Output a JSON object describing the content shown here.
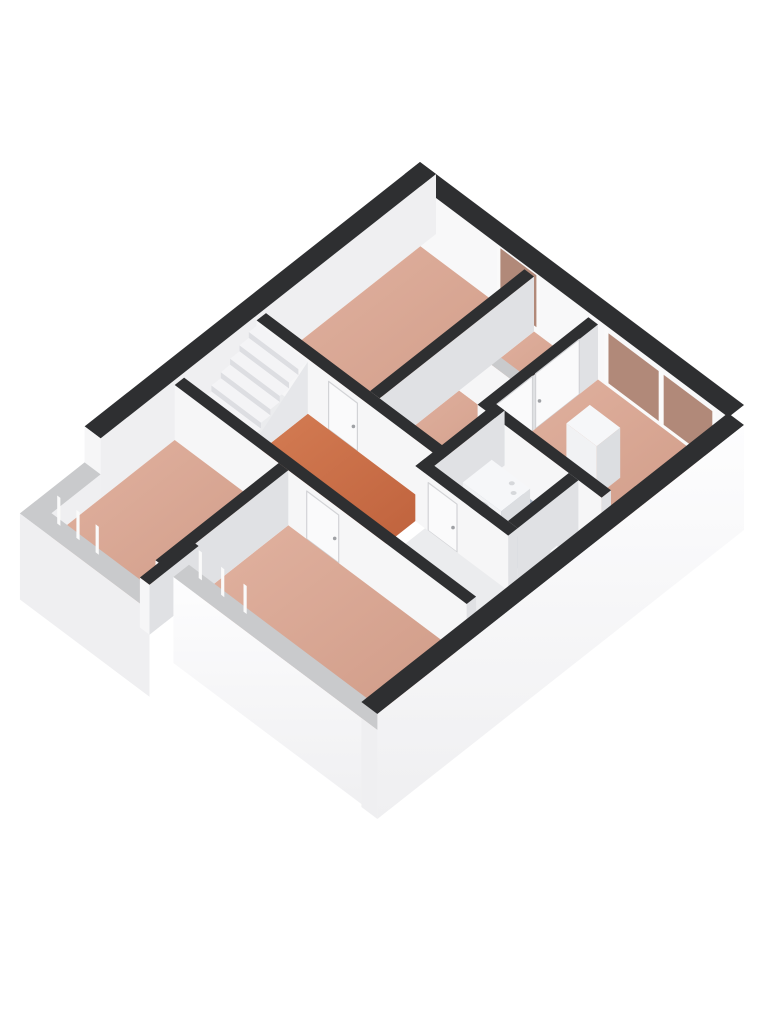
{
  "scene": {
    "type": "floor-plan-3d-isometric",
    "background": "#ffffff",
    "floor_level": "first-floor"
  },
  "colors": {
    "background": "#ffffff",
    "cap_dark": "#2e2f31",
    "cap_light": "#c9cacc",
    "face_bright": "#f6f6f7",
    "face_shaded": "#e0e1e4",
    "face_ne_inner": "#f8f8f9",
    "face_nw_inner": "#efeff1",
    "floor_salmon": "#d5a28f",
    "floor_salmon_light": "#e1b2a0",
    "floor_salmon_dark": "#cf9a86",
    "floor_orange": "#c96f4a",
    "floor_orange_light": "#d57e55",
    "floor_orange_dark": "#bd5f3a",
    "floor_blue": "#a9b4c3",
    "floor_blue_light": "#b6c0ce",
    "floor_blue_dark": "#9daaba",
    "floor_light": "#ebecee",
    "glass_brown": "#b18979",
    "skirt_white": "#fdfdfe",
    "skirt_gray": "#efeff1",
    "stair_tread": "#f4f4f6",
    "stair_riser": "#dddee2",
    "stair_stringer": "#e6e7ea",
    "door_panel": "#fafafb",
    "door_frame": "#d2d3d6",
    "handle": "#9fa1a5",
    "fixture_white": "#f1f2f4",
    "fixture_top": "#f6f7f9",
    "fixture_shaded": "#dcdee1",
    "washer_door": "#3f4246",
    "washer_door_inner": "#2c2e31",
    "window_frame": "#fafafa"
  },
  "rooms": [
    {
      "id": "room-top-bedroom",
      "floor": "salmon"
    },
    {
      "id": "closet-front",
      "floor": "salmon"
    },
    {
      "id": "closet-back",
      "floor": "salmon"
    },
    {
      "id": "room-right-bedroom",
      "floor": "salmon"
    },
    {
      "id": "stair-hall",
      "floor": "light"
    },
    {
      "id": "hall-landing",
      "floor": "orange"
    },
    {
      "id": "bathroom",
      "floor": "blue"
    },
    {
      "id": "toilet-nook",
      "floor": "light"
    },
    {
      "id": "corridor",
      "floor": "light"
    },
    {
      "id": "room-left-bedroom",
      "floor": "salmon"
    },
    {
      "id": "room-bottom-bedroom",
      "floor": "salmon"
    }
  ],
  "fixtures": [
    {
      "id": "staircase-winder",
      "room": "stair-hall"
    },
    {
      "id": "washing-machine",
      "room": "bathroom"
    },
    {
      "id": "water-tap",
      "room": "bathroom"
    },
    {
      "id": "toilet",
      "room": "toilet-nook"
    },
    {
      "id": "wardrobe",
      "room": "room-right-bedroom"
    }
  ],
  "windows": [
    {
      "id": "window-top-tall",
      "wall": "north-east"
    },
    {
      "id": "window-right-double",
      "wall": "north-east"
    },
    {
      "id": "window-left-low",
      "wall": "south-west"
    },
    {
      "id": "window-bottom-low",
      "wall": "south-west"
    }
  ],
  "doors": [
    {
      "id": "door-top-bedroom"
    },
    {
      "id": "door-closet-left"
    },
    {
      "id": "door-closet-right"
    },
    {
      "id": "door-bathroom"
    },
    {
      "id": "door-bottom-bedroom"
    }
  ]
}
